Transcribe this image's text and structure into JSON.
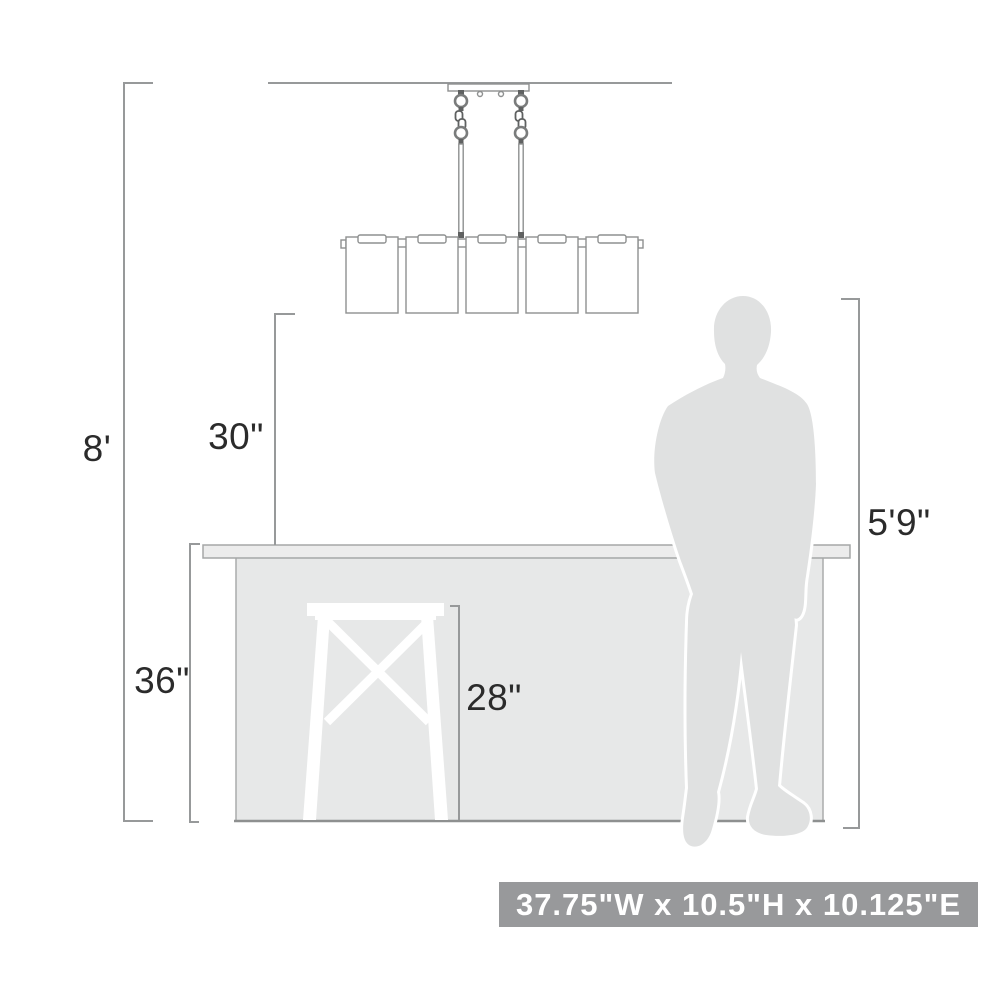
{
  "diagram": {
    "kind": "product-dimension-diagram",
    "subject": "5-light linear chandelier hung over bar counter with stool and person for scale"
  },
  "labels": {
    "ceiling_height": "8'",
    "fixture_to_counter": "30\"",
    "counter_height": "36\"",
    "stool_height": "28\"",
    "person_height": "5'9\""
  },
  "badge": {
    "text": "37.75\"W x 10.5\"H x 10.125\"E"
  },
  "colors": {
    "dimension_line": "#97999a",
    "fixture_line": "#8e9090",
    "counter_fill": "#e7e8e8",
    "countertop_fill": "#ececec",
    "person_fill": "#e0e1e1",
    "stool_fill": "#ffffff",
    "badge_bg": "#98999b",
    "badge_text": "#ffffff",
    "label_text": "#2b2b2b"
  }
}
